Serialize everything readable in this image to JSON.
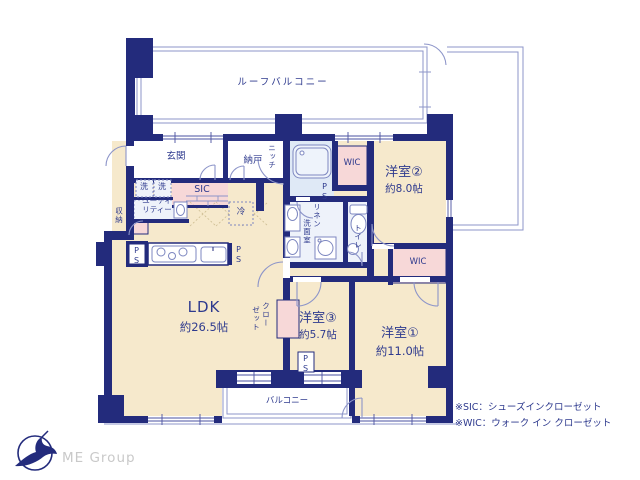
{
  "colors": {
    "wall_navy": "#232b7c",
    "room_cream": "#f6e9cc",
    "closet_pink": "#f7d8d8",
    "wet_blue": "#e7edf8",
    "outline_purple": "#8d95c9",
    "text_navy": "#2e3a8e",
    "logo_gray": "#c9c9c9"
  },
  "plan": {
    "roof_balcony": "ルーフバルコニー",
    "balcony": "バルコニー",
    "entrance": "玄関",
    "storage_room": "納戸",
    "niche": "ニッチ",
    "wic": "WIC",
    "room1": {
      "name": "洋室①",
      "size": "約11.0帖"
    },
    "room2": {
      "name": "洋室②",
      "size": "約8.0帖"
    },
    "room3": {
      "name": "洋室③",
      "size": "約5.7帖"
    },
    "ldk": {
      "name": "LDK",
      "size": "約26.5帖"
    },
    "linen": "リネン",
    "washroom": "洗面室",
    "toilet": "トイレ",
    "sic": "SIC",
    "utility_line1": "ユーティ",
    "utility_line2": "リティー",
    "washer": "洗",
    "closet_col1": "クロー",
    "closet_col2": "ゼット",
    "storage": "収納",
    "fridge": "冷",
    "ps": "PS"
  },
  "notes": {
    "sic": "※SIC：シューズインクローゼット",
    "wic": "※WIC：ウォーク イン クローゼット"
  },
  "branding": {
    "company": "ME Group"
  }
}
